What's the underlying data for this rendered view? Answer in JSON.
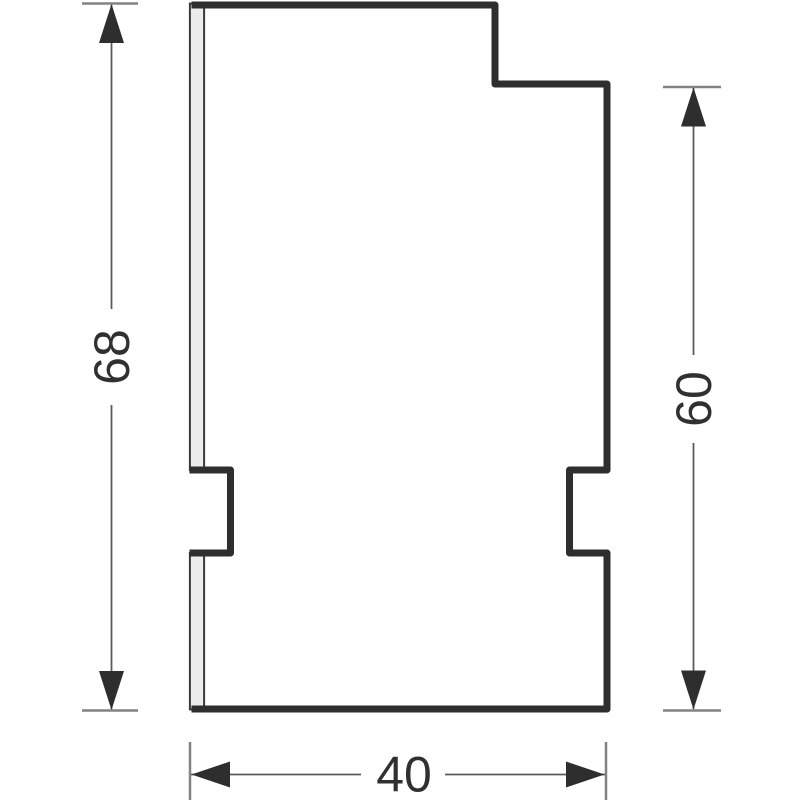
{
  "drawing": {
    "type": "technical-cross-section",
    "dimensions": {
      "left_height": "68",
      "right_height": "60",
      "bottom_width": "40"
    },
    "colors": {
      "background": "#ffffff",
      "part_outline": "#2e2e2e",
      "foil_strip_fill": "#ececec",
      "dimension_line": "#5c5c5c",
      "extension_tick": "#828282",
      "text": "#303030"
    }
  }
}
